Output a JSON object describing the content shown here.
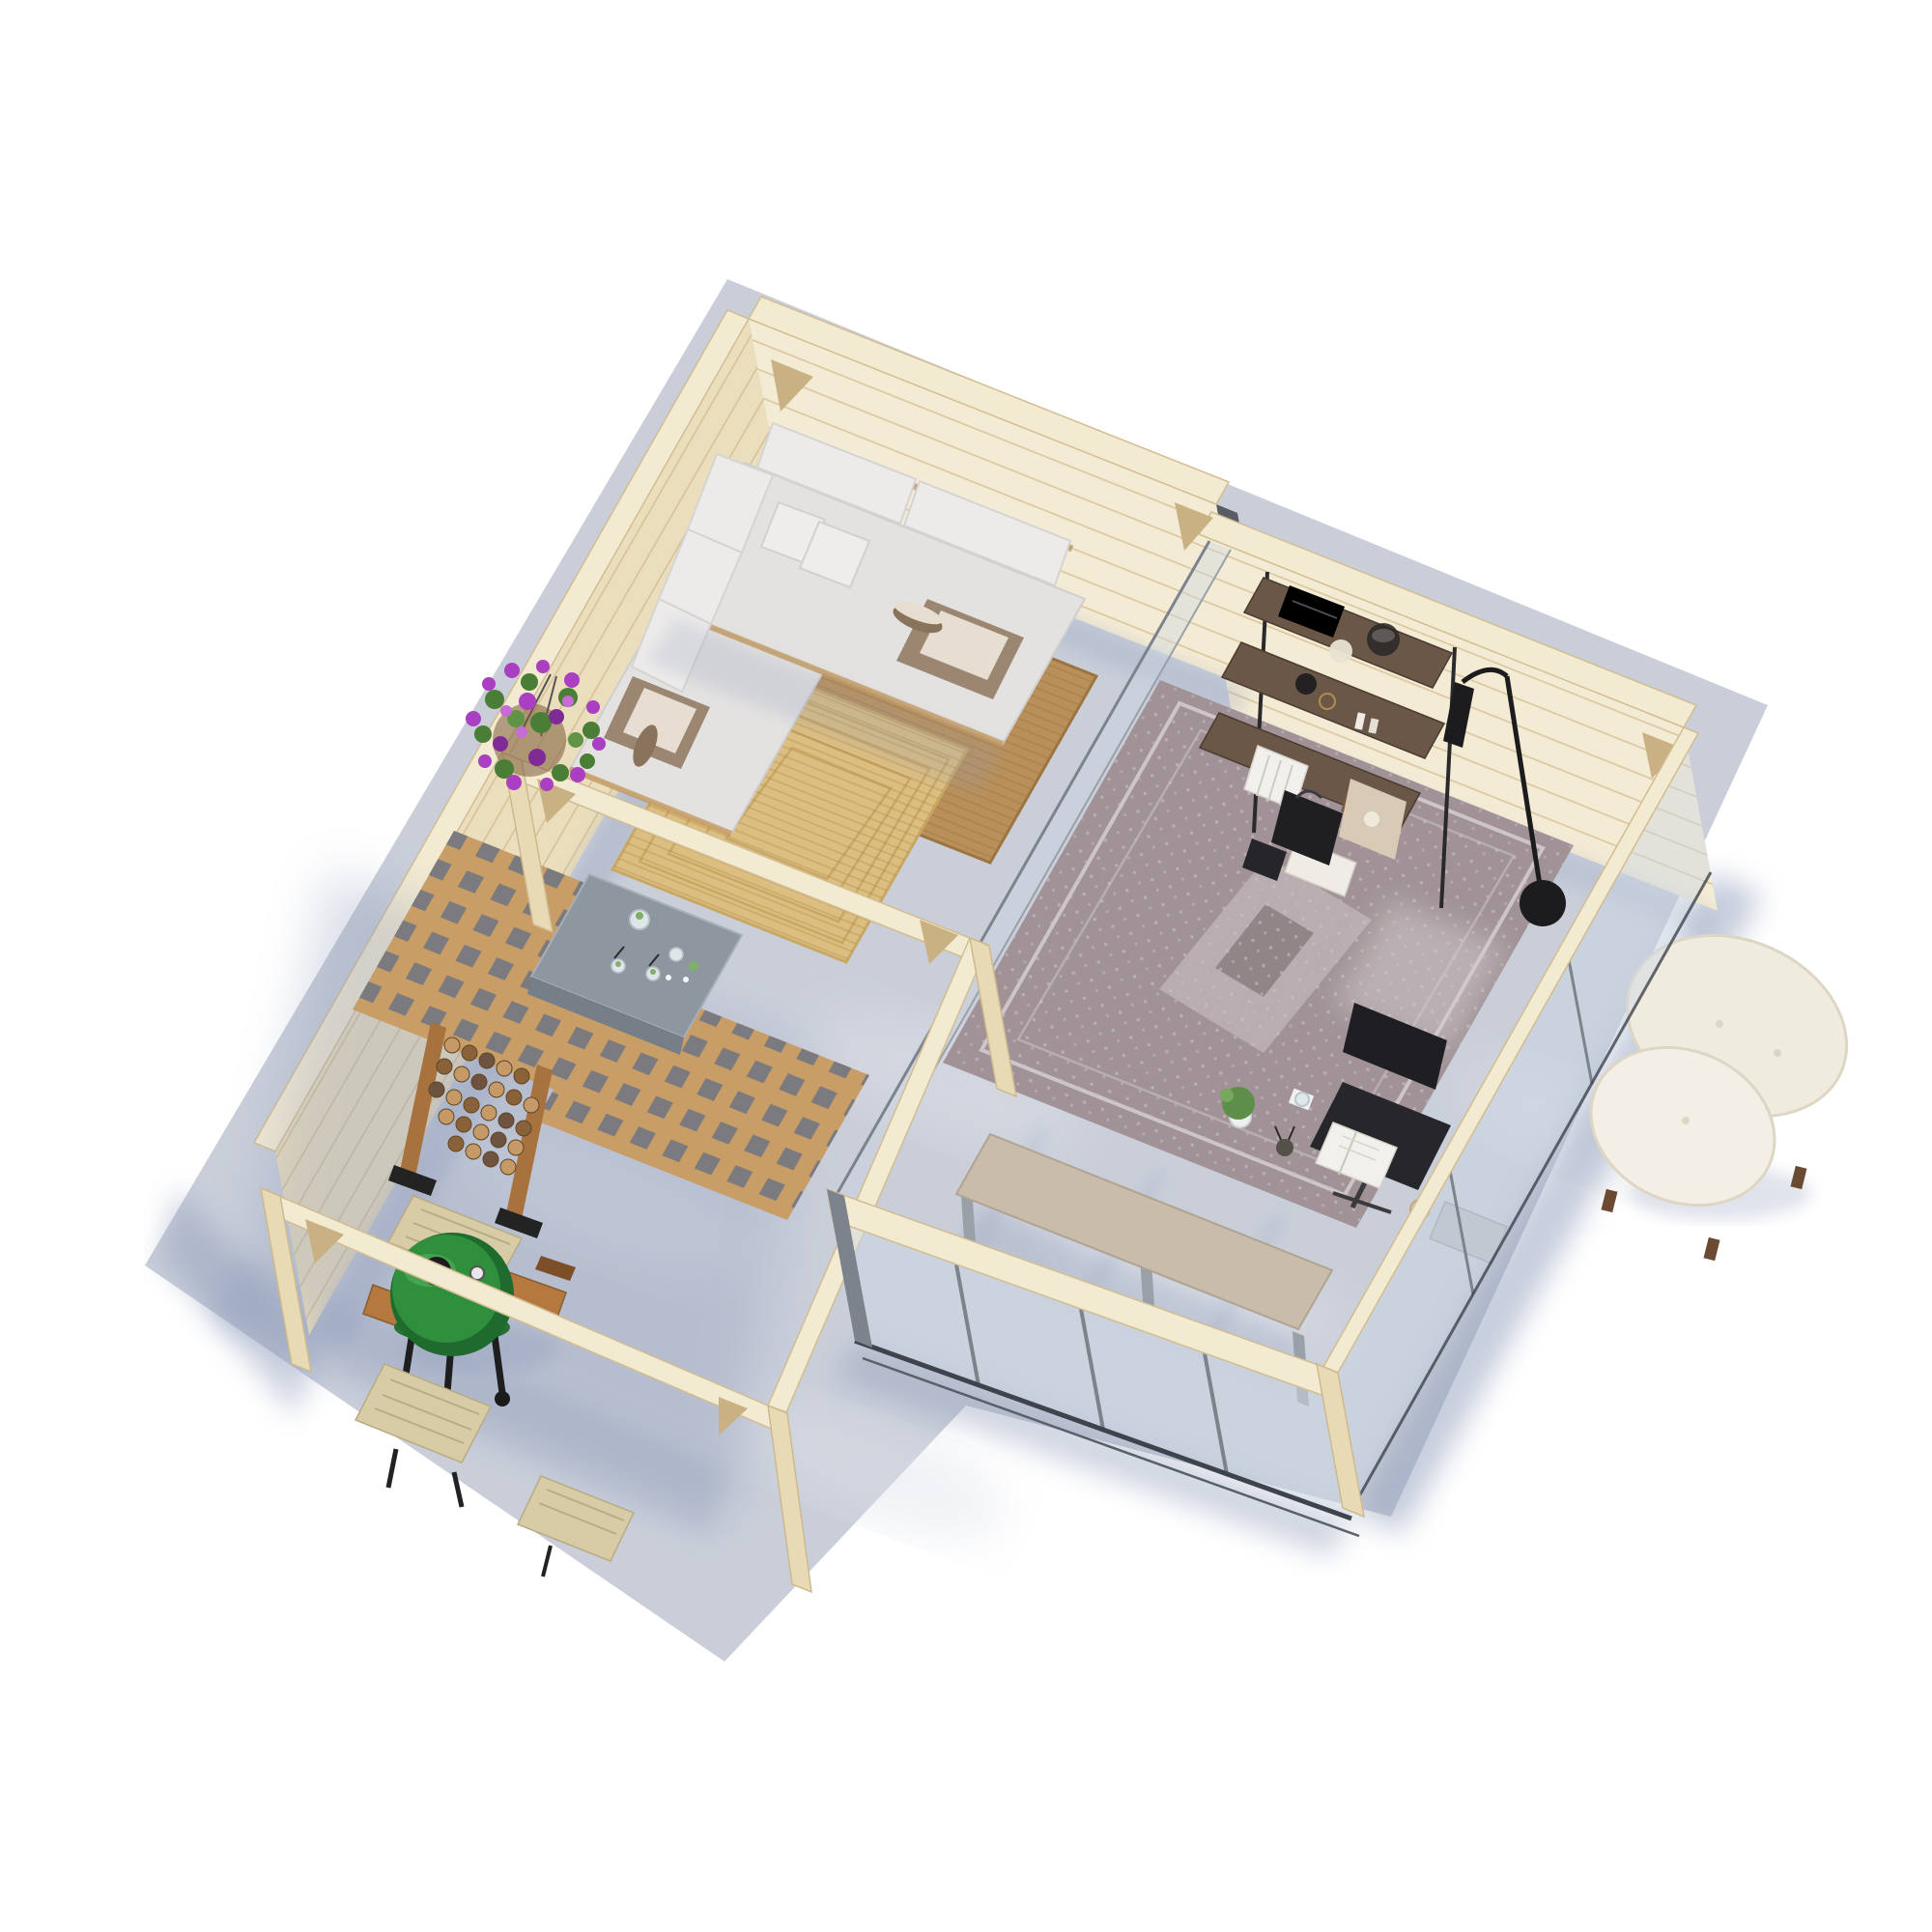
{
  "meta": {
    "background": "#ffffff",
    "scene_type": "aerial-3d-product-render",
    "subject": "L-shaped timber garden house with lounge room, glazed home office and open corner pergola on a concrete slab"
  },
  "palette": {
    "bg": "#ffffff",
    "slab": "#c9ced9",
    "slab_light": "#dde1e8",
    "shadow_blue": "#8f9cba",
    "wood_top": "#f3ead2",
    "wood_face": "#ebdebd",
    "wood_face_light": "#f4ebd4",
    "wood_edge": "#d2bd92",
    "wood_post": "#e9dab6",
    "brace": "#c9b183",
    "recess_dark": "#4b5058",
    "glass": "#cdd8e4",
    "glass_frame": "#7d838c",
    "rail_dark": "#3f444c",
    "sofa": "#e4e2e1",
    "sofa_shade": "#cfcecd",
    "pillow": "#edebea",
    "throw_brown": "#9b8672",
    "throw_roll": "#8a735c",
    "wicker": "#a9824f",
    "jute_dark": "#b9905a",
    "jute_light": "#dcbe80",
    "lattice_wood": "#c99d66",
    "table_concrete": "#8e969f",
    "drink_green": "#7fb069",
    "firewood_frame": "#a8723f",
    "log_light": "#c59a66",
    "log_mid": "#8a6239",
    "log_dark": "#6e5440",
    "grill_green": "#2f8f3d",
    "grill_green_dark": "#1e6b2d",
    "grill_black": "#232323",
    "grill_wood": "#b5793f",
    "slat_wood": "#d8cca6",
    "flower_purple": "#ab3fc2",
    "flower_purple_dark": "#7e2b96",
    "leaf_green": "#4a7d35",
    "shelf_bronze": "#6b5747",
    "shelf_dark": "#2a2a2c",
    "lamp_black": "#1c1c1e",
    "boucle": "#f0ebdf",
    "boucle_shade": "#ded6c4",
    "leg_brown": "#6b4a33",
    "rug_office": "#a09296",
    "rug_office_light": "#cdc5c8",
    "office_chair": "#27272b",
    "desk_wood": "#c9bcab",
    "leg_gray": "#9aa0a8",
    "bag_black": "#1f1f22",
    "bag_beige": "#d8cab4",
    "book_white": "#f2f0ec",
    "book_brown": "#7a5c42",
    "plant_green": "#5e8f4a",
    "pot_white": "#eef0f2"
  },
  "scene": {
    "rooms": [
      {
        "name": "lounge",
        "walls": "timber plank walls on north and west",
        "objects": [
          "corner-sofa",
          "back-cushions",
          "scatter-pillows",
          "brown-throw-blankets",
          "jute-rug-dark",
          "jute-rug-light"
        ]
      },
      {
        "name": "home-office",
        "walls": "timber plank walls north, glass walls east and south, glass partition to lounge",
        "objects": [
          "shelving-unit",
          "books",
          "glass-bowl",
          "black-vase",
          "pampas-vase",
          "floor-lamp",
          "boucle-armchair",
          "oriental-rug",
          "office-chair",
          "desk",
          "potted-plant",
          "water-glass",
          "open-book",
          "pencil-cup",
          "shopping-bags"
        ]
      },
      {
        "name": "pergola",
        "walls": "open timber post-and-beam frame, timber wall on west",
        "objects": [
          "lattice-panels",
          "concrete-coffee-table",
          "mojito-drinks",
          "hanging-flower-basket",
          "firewood-rack",
          "kamado-grill",
          "folding-slat-table",
          "folding-slat-chairs"
        ]
      }
    ]
  }
}
